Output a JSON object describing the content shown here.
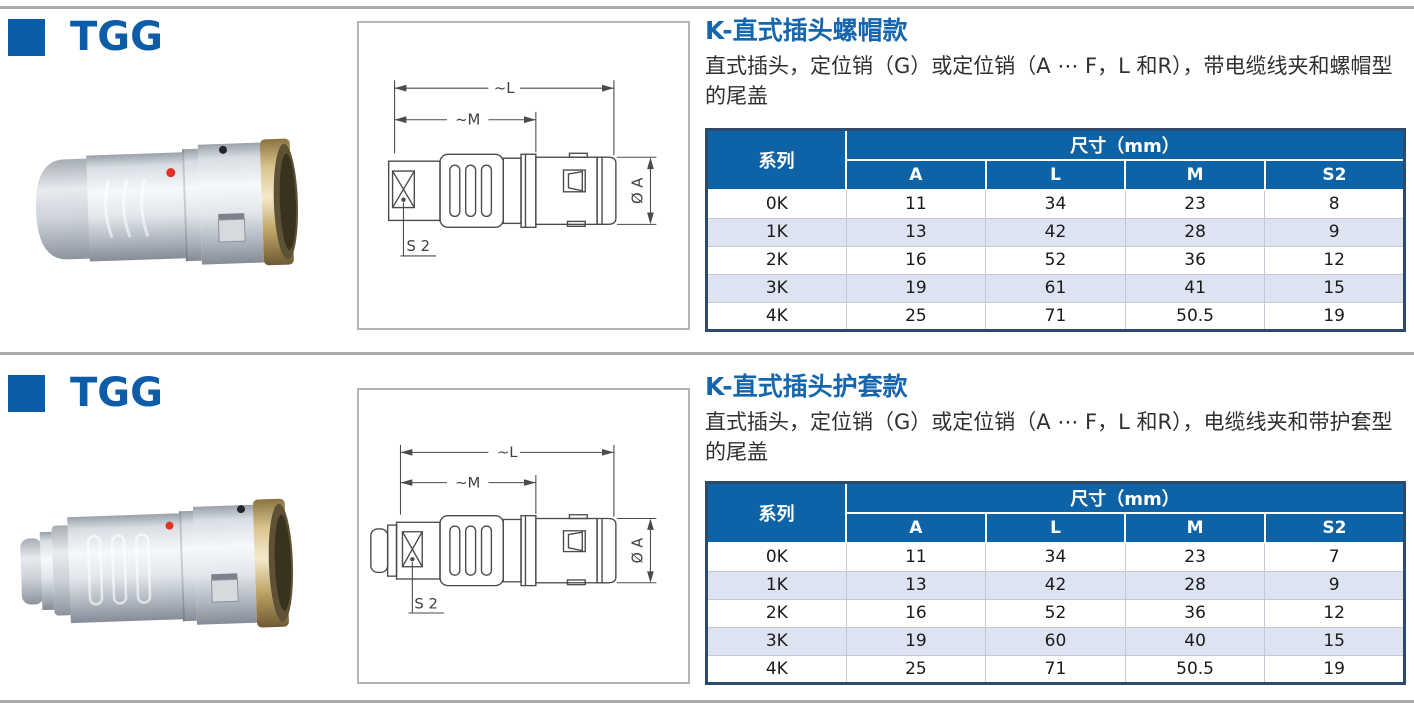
{
  "colors": {
    "brand_blue": "#0d5ca8",
    "title_blue": "#1666ae",
    "table_header_blue": "#0e63a6",
    "table_stripe": "#dde3f0",
    "divider_gray": "#a9aaad"
  },
  "sections": [
    {
      "series_label": "TGG",
      "title": "K-直式插头螺帽款",
      "description": "直式插头，定位销（G）或定位销（A ⋯ F，L 和R），带电缆线夹和螺帽型的尾盖",
      "drawing": {
        "length_label": "~L",
        "mid_length_label": "~M",
        "diameter_label": "Ø A",
        "wrench_label": "S 2"
      },
      "table": {
        "series_header": "系列",
        "dims_header": "尺寸（mm）",
        "columns": [
          "A",
          "L",
          "M",
          "S2"
        ],
        "rows": [
          {
            "series": "0K",
            "values": [
              "11",
              "34",
              "23",
              "8"
            ]
          },
          {
            "series": "1K",
            "values": [
              "13",
              "42",
              "28",
              "9"
            ]
          },
          {
            "series": "2K",
            "values": [
              "16",
              "52",
              "36",
              "12"
            ]
          },
          {
            "series": "3K",
            "values": [
              "19",
              "61",
              "41",
              "15"
            ]
          },
          {
            "series": "4K",
            "values": [
              "25",
              "71",
              "50.5",
              "19"
            ]
          }
        ]
      }
    },
    {
      "series_label": "TGG",
      "title": "K-直式插头护套款",
      "description": "直式插头，定位销（G）或定位销（A ⋯ F，L 和R），电缆线夹和带护套型的尾盖",
      "drawing": {
        "length_label": "~L",
        "mid_length_label": "~M",
        "diameter_label": "Ø A",
        "wrench_label": "S 2"
      },
      "table": {
        "series_header": "系列",
        "dims_header": "尺寸（mm）",
        "columns": [
          "A",
          "L",
          "M",
          "S2"
        ],
        "rows": [
          {
            "series": "0K",
            "values": [
              "11",
              "34",
              "23",
              "7"
            ]
          },
          {
            "series": "1K",
            "values": [
              "13",
              "42",
              "28",
              "9"
            ]
          },
          {
            "series": "2K",
            "values": [
              "16",
              "52",
              "36",
              "12"
            ]
          },
          {
            "series": "3K",
            "values": [
              "19",
              "60",
              "40",
              "15"
            ]
          },
          {
            "series": "4K",
            "values": [
              "25",
              "71",
              "50.5",
              "19"
            ]
          }
        ]
      }
    }
  ]
}
